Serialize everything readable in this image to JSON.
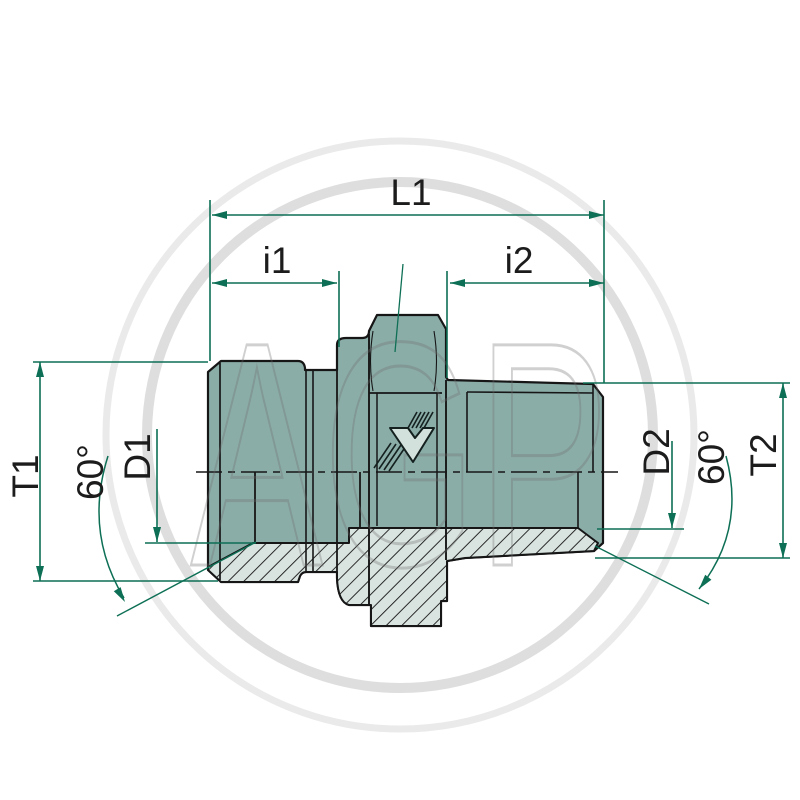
{
  "drawing": {
    "title": "hydraulic-adapter-technical-drawing",
    "watermark_text": "AGP",
    "labels": {
      "overall_length": "L1",
      "thread_length_left": "i1",
      "thread_length_right": "i2",
      "thread_size_left": "T1",
      "cone_diameter_left": "D1",
      "cone_angle_left": "60°",
      "cone_diameter_right": "D2",
      "cone_angle_right": "60°",
      "thread_size_right": "T2"
    },
    "logo_letter": "V",
    "colors": {
      "body_fill": "#8badа8",
      "body_fill_hex": "#8badа8",
      "section_fill": "#d9e4e0",
      "dimension_green": "#0d6f55",
      "outline_black": "#161616",
      "watermark_gray": "#a0a0a0"
    }
  }
}
